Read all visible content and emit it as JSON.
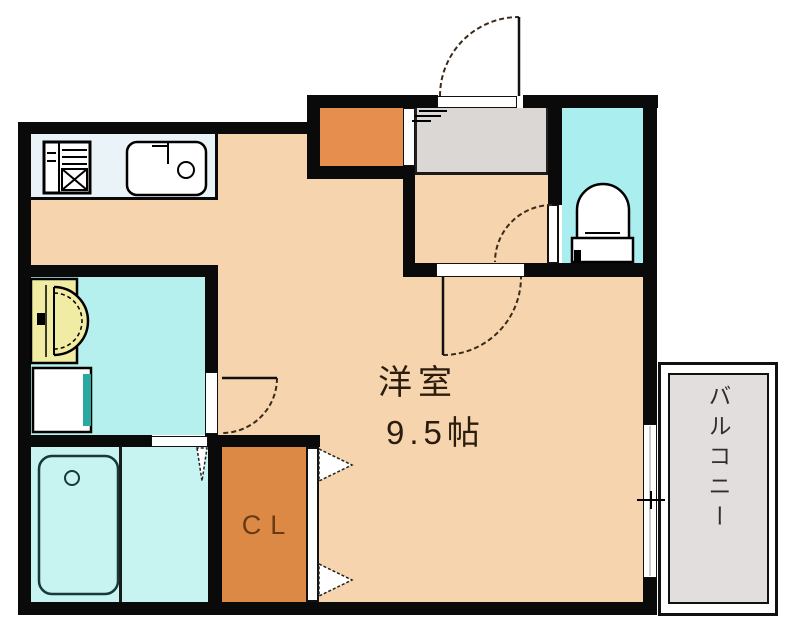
{
  "title": "apartment-floor-plan",
  "rooms": {
    "main_room": {
      "name_label": "洋室",
      "size_label": "9.5帖"
    },
    "closet": {
      "label": "CL"
    },
    "balcony": {
      "label": "バルコニー"
    }
  },
  "icons": [
    "stove-icon",
    "kitchen-sink-icon",
    "vanity-sink-icon",
    "washing-machine-icon",
    "bathtub-icon",
    "toilet-icon",
    "entrance-door-arc-icon",
    "room-door-arc-icon",
    "toilet-door-arc-icon",
    "washroom-door-arc-icon",
    "folding-door-icon",
    "closet-door-arrow-icon",
    "window-handle-icon",
    "entrance-step-icon"
  ],
  "colors": {
    "wall": "#0a0a0a",
    "floor_main": "#f6d4ae",
    "genkan_orange": "#e58e4d",
    "closet_orange": "#dc8946",
    "hall_gray": "#dbd7d4",
    "balcony_gray": "#e2dede",
    "toilet_cyan": "#abeef0",
    "washroom_cyan": "#b6f0ee",
    "bathroom_cyan": "#c7f3f0",
    "kitchen_counter": "#eaf4f8",
    "vanity_yellow": "#f1eca3",
    "washer_teal": "#2aa9a1",
    "room_label_text": "#2b1c0e",
    "closet_label_text": "#6b3a12",
    "balcony_label_text": "#2e2e2e"
  }
}
